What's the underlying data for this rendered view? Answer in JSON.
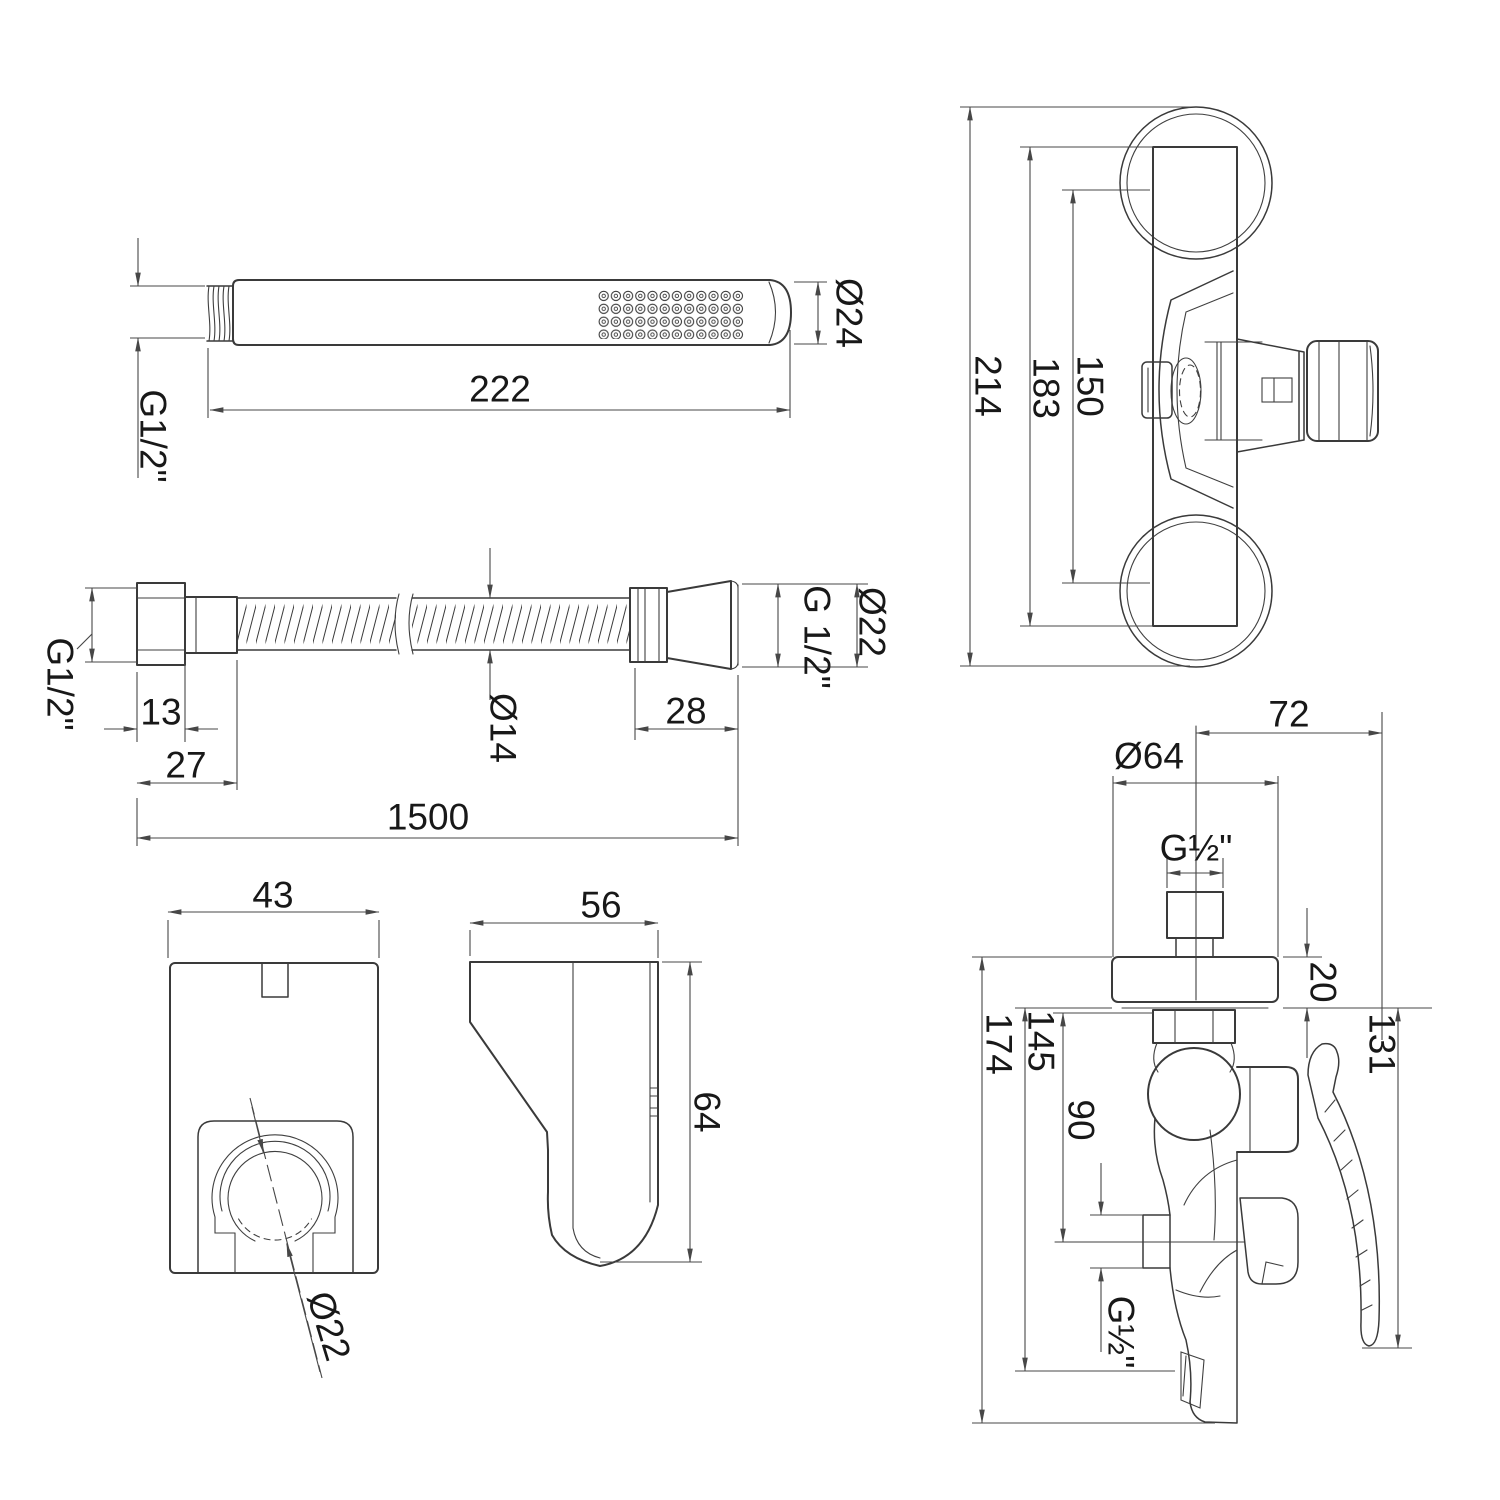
{
  "drawing": {
    "hand_shower": {
      "length": "222",
      "diameter": "Ø24",
      "thread": "G1/2\""
    },
    "mixer_top": {
      "overall_height": "214",
      "body_height": "183",
      "mount_distance": "150"
    },
    "hose": {
      "thread_left": "G1/2\"",
      "nut_length": "13",
      "fitting_left": "27",
      "inner_diameter": "Ø14",
      "fitting_right": "28",
      "total_length": "1500",
      "outer_diameter": "Ø22",
      "thread_right": "G 1/2\""
    },
    "holder_front": {
      "width": "43",
      "opening_diameter": "Ø22"
    },
    "holder_side": {
      "depth": "56",
      "height": "64"
    },
    "mixer_side": {
      "reach": "72",
      "flange_diameter": "Ø64",
      "inlet_thread": "G½\"",
      "flange_thickness": "20",
      "to_outlet_center": "90",
      "to_body_bottom": "145",
      "overall_height": "174",
      "lever_length": "131",
      "outlet_thread": "G½\""
    }
  }
}
